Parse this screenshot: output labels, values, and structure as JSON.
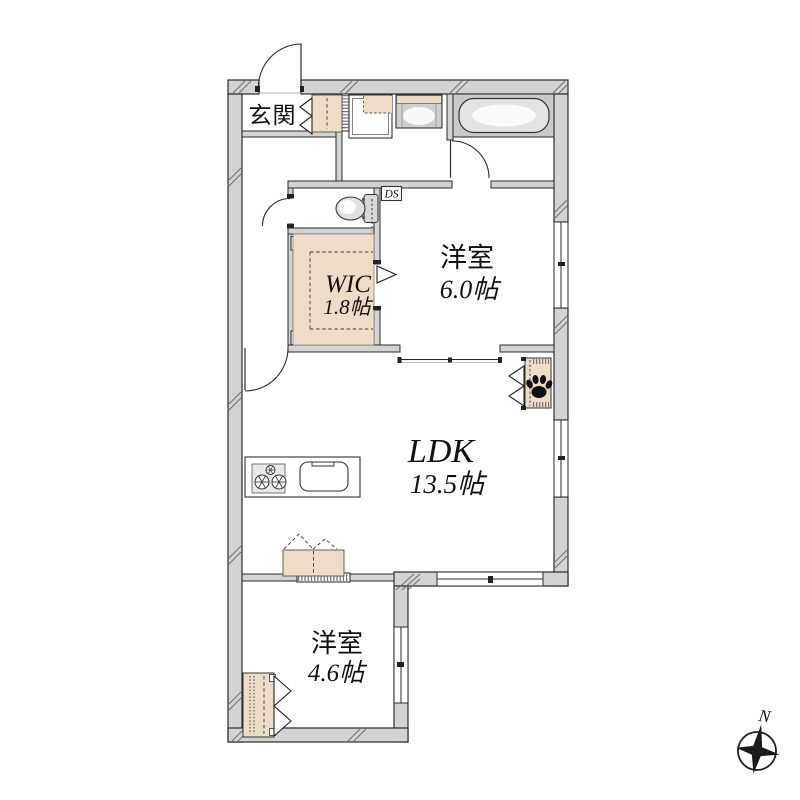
{
  "meta": {
    "type": "japanese-apartment-floor-plan"
  },
  "rooms": {
    "genkan": {
      "label": "玄関"
    },
    "wic": {
      "label": "WIC",
      "size": "1.8帖"
    },
    "bedroom_upper": {
      "label": "洋室",
      "size": "6.0帖"
    },
    "ldk": {
      "label": "LDK",
      "size": "13.5帖"
    },
    "bedroom_lower": {
      "label": "洋室",
      "size": "4.6帖"
    }
  },
  "shafts": {
    "ds": "DS",
    "ps_upper": "PS",
    "ps_lower": "PS"
  },
  "compass": {
    "north_label": "N"
  },
  "colors": {
    "wall_fill": "#d3d3d3",
    "accent_beige": "#eddcc6",
    "bath_gray": "#c9c9c9",
    "line": "#2b2b2b",
    "paw_black": "#111111"
  },
  "icons": {
    "paw": "paw-icon",
    "compass": "compass-rose-icon",
    "toilet": "toilet-icon",
    "bathtub": "bathtub-icon",
    "stove": "stove-burners-icon",
    "sink": "kitchen-sink-icon"
  }
}
